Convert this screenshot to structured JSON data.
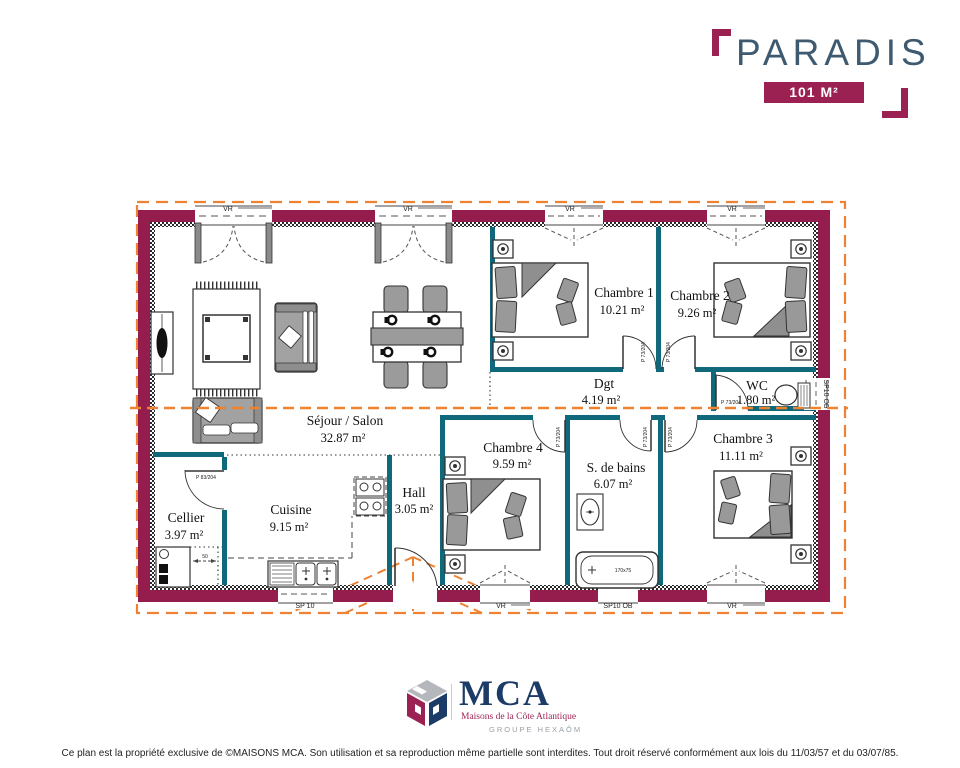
{
  "title_block": {
    "model_name": "PARADIS",
    "area_badge": "101 M²"
  },
  "rooms": [
    {
      "name": "Séjour / Salon",
      "area": "32.87 m²"
    },
    {
      "name": "Chambre 1",
      "area": "10.21 m²"
    },
    {
      "name": "Chambre 2",
      "area": "9.26 m²"
    },
    {
      "name": "Dgt",
      "area": "4.19 m²"
    },
    {
      "name": "WC",
      "area": "1.80 m²"
    },
    {
      "name": "Chambre 4",
      "area": "9.59 m²"
    },
    {
      "name": "S. de bains",
      "area": "6.07 m²"
    },
    {
      "name": "Chambre 3",
      "area": "11.11 m²"
    },
    {
      "name": "Cellier",
      "area": "3.97 m²"
    },
    {
      "name": "Cuisine",
      "area": "9.15 m²"
    },
    {
      "name": "Hall",
      "area": "3.05 m²"
    }
  ],
  "labels": {
    "door_interior": "P 73/204",
    "door_cellier": "P 83/204",
    "window_vr": "VR",
    "window_sp10": "SP 10",
    "window_sp10ob": "SP10 OB",
    "bathtub_size": "170x75",
    "dim_50": "50"
  },
  "footer": {
    "brand": "MCA",
    "brand_sub": "Maisons de la Côte Atlantique",
    "brand_group": "GROUPE HEXAÔM",
    "disclaimer": "Ce plan est la propriété exclusive de ©MAISONS MCA. Son utilisation et sa reproduction même partielle sont interdites. Tout droit réservé conformément aux lois du 11/03/57 et du 03/07/85."
  },
  "colors": {
    "exterior_wall": "#951d4e",
    "interior_wall": "#10697a",
    "roof_line": "#ef8232",
    "accent": "#9c2153",
    "title": "#3e5a70",
    "brand_navy": "#1c3b66"
  }
}
